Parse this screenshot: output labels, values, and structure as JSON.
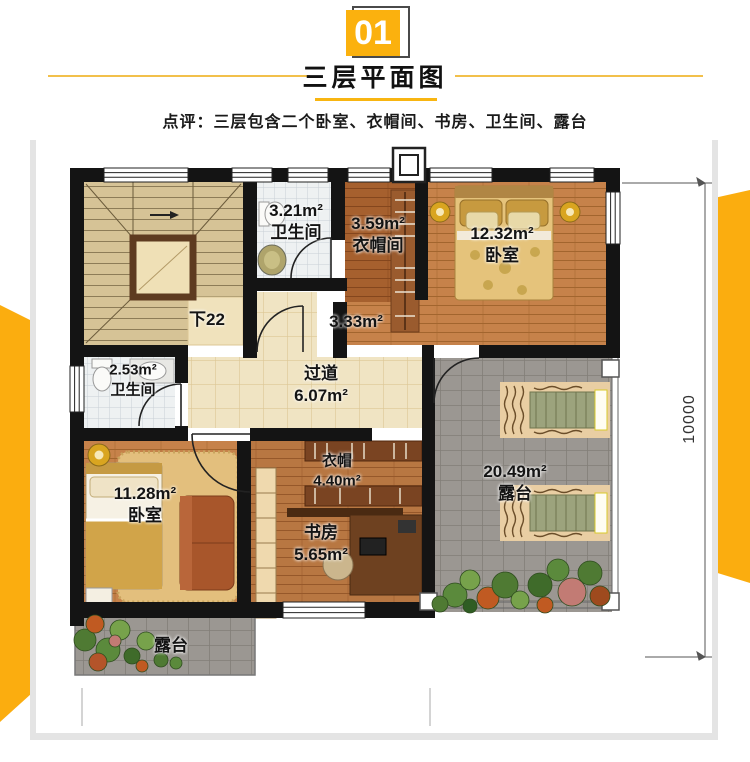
{
  "header": {
    "badge": "01",
    "title": "三层平面图",
    "comment": "点评：三层包含二个卧室、衣帽间、书房、卫生间、露台"
  },
  "rooms": {
    "stairs": {
      "label": "下22"
    },
    "bathTop": {
      "area": "3.21m²",
      "name": "卫生间"
    },
    "cloakTop": {
      "area": "3.59m²",
      "name": "衣帽间"
    },
    "bedroomTop": {
      "area": "12.32m²",
      "name": "卧室"
    },
    "passage": {
      "area": "3.33m²"
    },
    "bathLeft": {
      "area": "2.53m²",
      "name": "卫生间"
    },
    "hallway": {
      "name": "过道",
      "area": "6.07m²"
    },
    "cloakMid": {
      "name": "衣帽",
      "area": "4.40m²"
    },
    "bedroomLeft": {
      "area": "11.28m²",
      "name": "卧室"
    },
    "study": {
      "name": "书房",
      "area": "5.65m²"
    },
    "terraceRight": {
      "area": "20.49m²",
      "name": "露台"
    },
    "terraceBottom": {
      "name": "露台"
    }
  },
  "dimension": {
    "height_label": "10000"
  },
  "colors": {
    "accent_yellow": "#FBB10E",
    "wall_black": "#141414",
    "wood_floor": "#C6824A",
    "tile_beige": "#F0E4C3",
    "tile_gray": "#9B9792"
  }
}
